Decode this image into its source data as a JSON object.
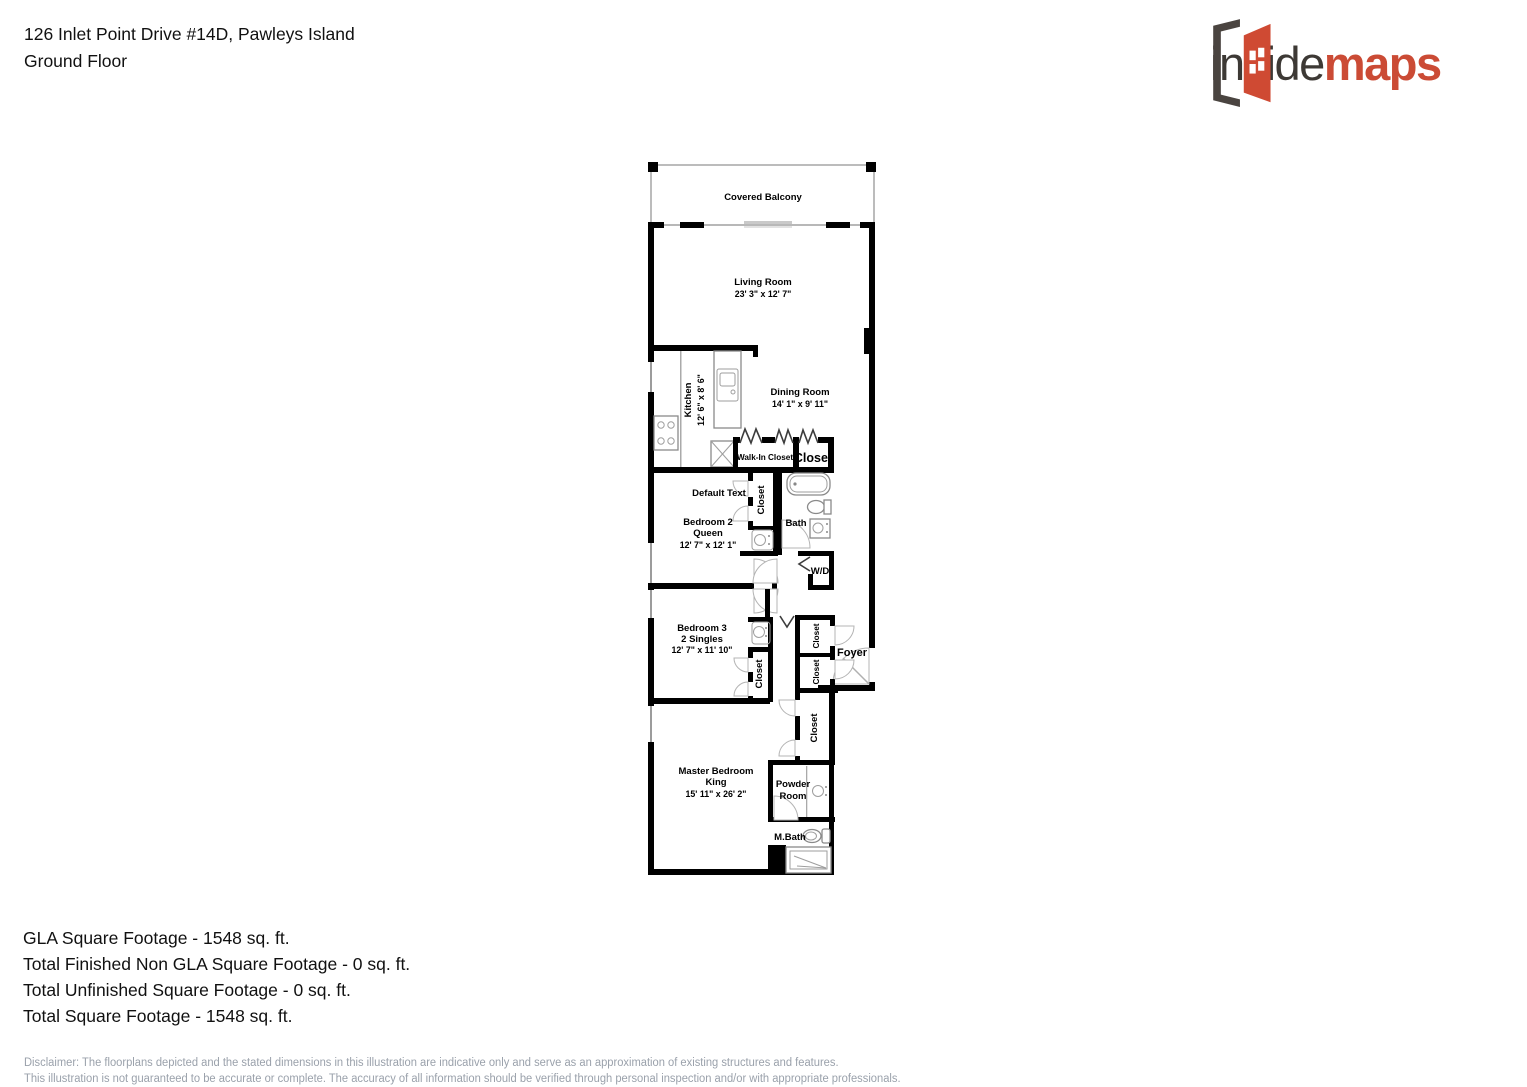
{
  "header": {
    "address": "126 Inlet Point Drive #14D, Pawleys Island",
    "floor": "Ground Floor"
  },
  "logo": {
    "word1": "inside",
    "word2": "maps",
    "dark_color": "#3d3935",
    "accent_color": "#cb4b35"
  },
  "plan": {
    "covered_balcony": {
      "name": "Covered Balcony"
    },
    "living_room": {
      "name": "Living Room",
      "dims": "23' 3\" x 12' 7\""
    },
    "kitchen": {
      "name": "Kitchen",
      "dims": "12' 6\" x 8' 6\""
    },
    "dining_room": {
      "name": "Dining Room",
      "dims": "14' 1\" x 9' 11\""
    },
    "walk_in_closet": {
      "name": "Walk-In Closet"
    },
    "closet": {
      "name": "Closet"
    },
    "default_text": {
      "name": "Default Text"
    },
    "bedroom2": {
      "name": "Bedroom 2",
      "bed": "Queen",
      "dims": "12' 7\" x 12' 1\""
    },
    "bath": {
      "name": "Bath"
    },
    "wd": {
      "name": "W/D"
    },
    "bedroom3": {
      "name": "Bedroom 3",
      "bed": "2 Singles",
      "dims": "12' 7\" x 11' 10\""
    },
    "foyer": {
      "name": "Foyer"
    },
    "master_bedroom": {
      "name": "Master Bedroom",
      "bed": "King",
      "dims": "15' 11\" x 26' 2\""
    },
    "powder_room": {
      "line1": "Powder",
      "line2": "Room"
    },
    "master_bath": {
      "name": "M.Bath"
    }
  },
  "footer": {
    "gla": "GLA Square Footage - 1548 sq. ft.",
    "non_gla": "Total Finished Non GLA Square Footage - 0 sq. ft.",
    "unfinished": "Total Unfinished Square Footage - 0 sq. ft.",
    "total": "Total Square Footage - 1548 sq. ft.",
    "disclaimer1": "Disclaimer: The floorplans depicted and the stated dimensions in this illustration are indicative only and serve as an approximation of existing structures and features.",
    "disclaimer2": "This illustration is not guaranteed to be accurate or complete. The accuracy of all information should be verified through personal inspection and/or with appropriate professionals."
  }
}
